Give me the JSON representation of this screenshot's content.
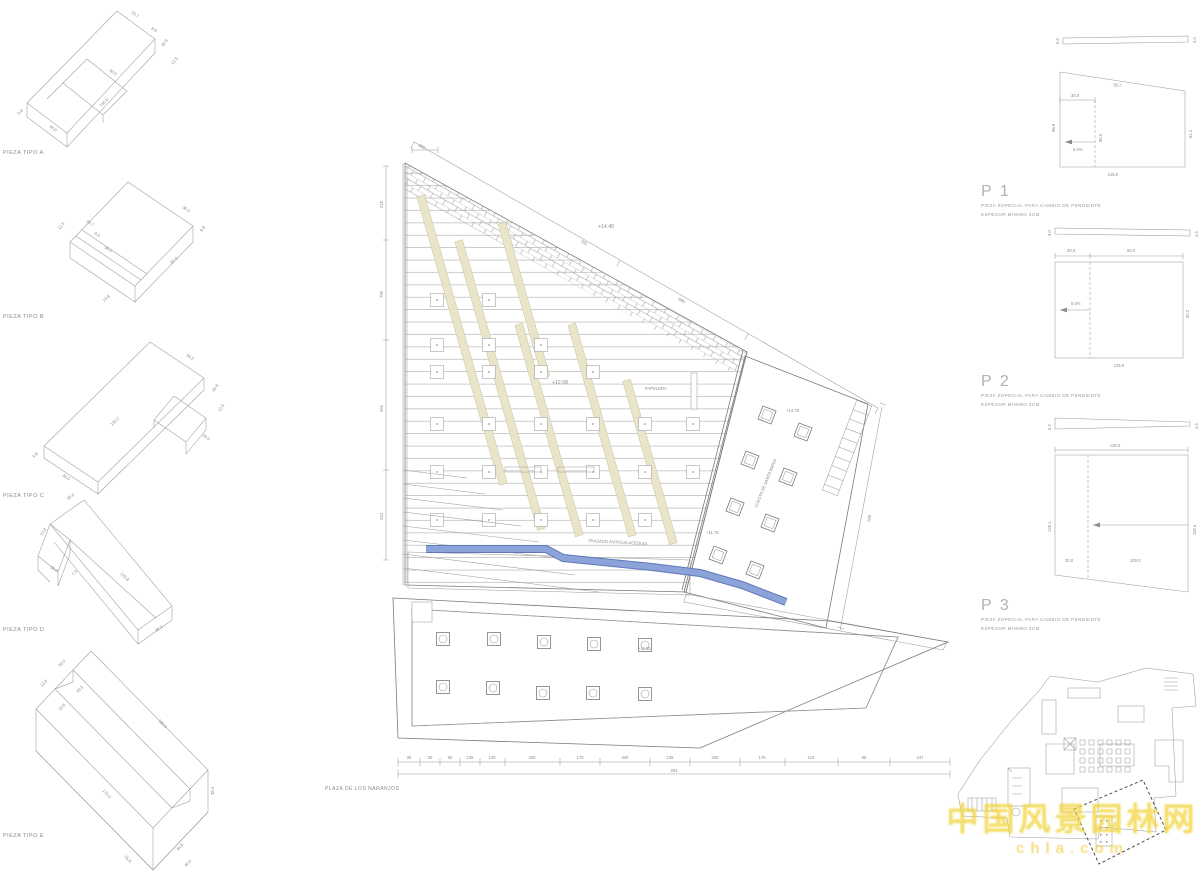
{
  "sheet": {
    "background": "#ffffff"
  },
  "colors": {
    "line": "#9b9b9b",
    "line_dark": "#7a7a7a",
    "text": "#8a8a8a",
    "cream_fill": "#e9e5c9",
    "cream_stroke": "#c8c3a3",
    "water_fill": "#8ba3d8",
    "water_edge": "#6079b8",
    "watermark": "#f2d540"
  },
  "pieces": {
    "a": {
      "label": "PIEZA TIPO A",
      "dims": [
        "23.7",
        "8.0",
        "30.8",
        "12.8",
        "40.0",
        "130.0",
        "36.0",
        "9.8"
      ]
    },
    "b": {
      "label": "PIEZA TIPO B",
      "dims": [
        "36.3",
        "9.8",
        "12.5",
        "23.7",
        "8.0",
        "36.0",
        "87.0",
        "13.8"
      ]
    },
    "c": {
      "label": "PIEZA TIPO C",
      "dims": [
        "50.2",
        "30.8",
        "13.6",
        "30.0",
        "130.2",
        "36.0",
        "9.8"
      ]
    },
    "d": {
      "label": "PIEZA TIPO D",
      "dims": [
        "36.0",
        "13.8",
        "30.2",
        "7.5",
        "129.8",
        "36.2"
      ]
    },
    "e": {
      "label": "PIEZA TIPO E",
      "dims": [
        "30.0",
        "13.8",
        "30.5",
        "12.8",
        "180.0",
        "175.0",
        "25.8",
        "44.8",
        "38.4",
        "40.0"
      ]
    }
  },
  "plan": {
    "title": "PLAZA DE LOS NARANJOS",
    "labels": {
      "papelera": "PAPELERA",
      "acequia": "TRAZADO ANTIGUA ACEQUIA",
      "cuesta": "CUESTA DE SANTA MARIA"
    },
    "levels": {
      "top": "+14.40",
      "mid": "+12.08",
      "cuesta_top": "+14.75",
      "cuesta_low": "+11.75",
      "naranjos": "+11.35"
    },
    "dims": {
      "top_corner": "300",
      "slope_a": "750",
      "slope_b": "690",
      "right_side": "590",
      "left_side": [
        "218",
        "795",
        "656",
        "410"
      ],
      "bottom": [
        "30",
        "30",
        "90",
        "135",
        "120",
        "340",
        "170",
        "340",
        "135",
        "340",
        "170",
        "110",
        "96",
        "247"
      ],
      "bottom_total": "281"
    }
  },
  "details": {
    "note1": "PIEZA ESPECIAL PARA CAMBIO DE PENDIENTE",
    "note2": "ESPESOR MINIMO 4CM",
    "p1": {
      "id": "P 1",
      "bar_left": "5.5",
      "bar_right": "4.0",
      "top_left": "30.0",
      "top_slope": "33.7",
      "left": "98.8",
      "mid": "85.0",
      "slope": "5.0%",
      "right": "81.4",
      "bottom": "125.0"
    },
    "p2": {
      "id": "P 2",
      "bar_left": "3.0",
      "bar_right": "4.5",
      "top_left": "30.0",
      "top_right": "95.0",
      "slope": "5.0%",
      "right": "90.2",
      "bottom": "125.0"
    },
    "p3": {
      "id": "P 3",
      "bar_left": "6.2",
      "bar_right": "4.5",
      "top": "130.0",
      "left": "129.1",
      "right": "118.6",
      "seg_left": "30.0",
      "seg_right": "100.0"
    }
  },
  "keymap": {
    "watermark_line1": "中国风景园林网",
    "watermark_line2": "chla.com"
  }
}
